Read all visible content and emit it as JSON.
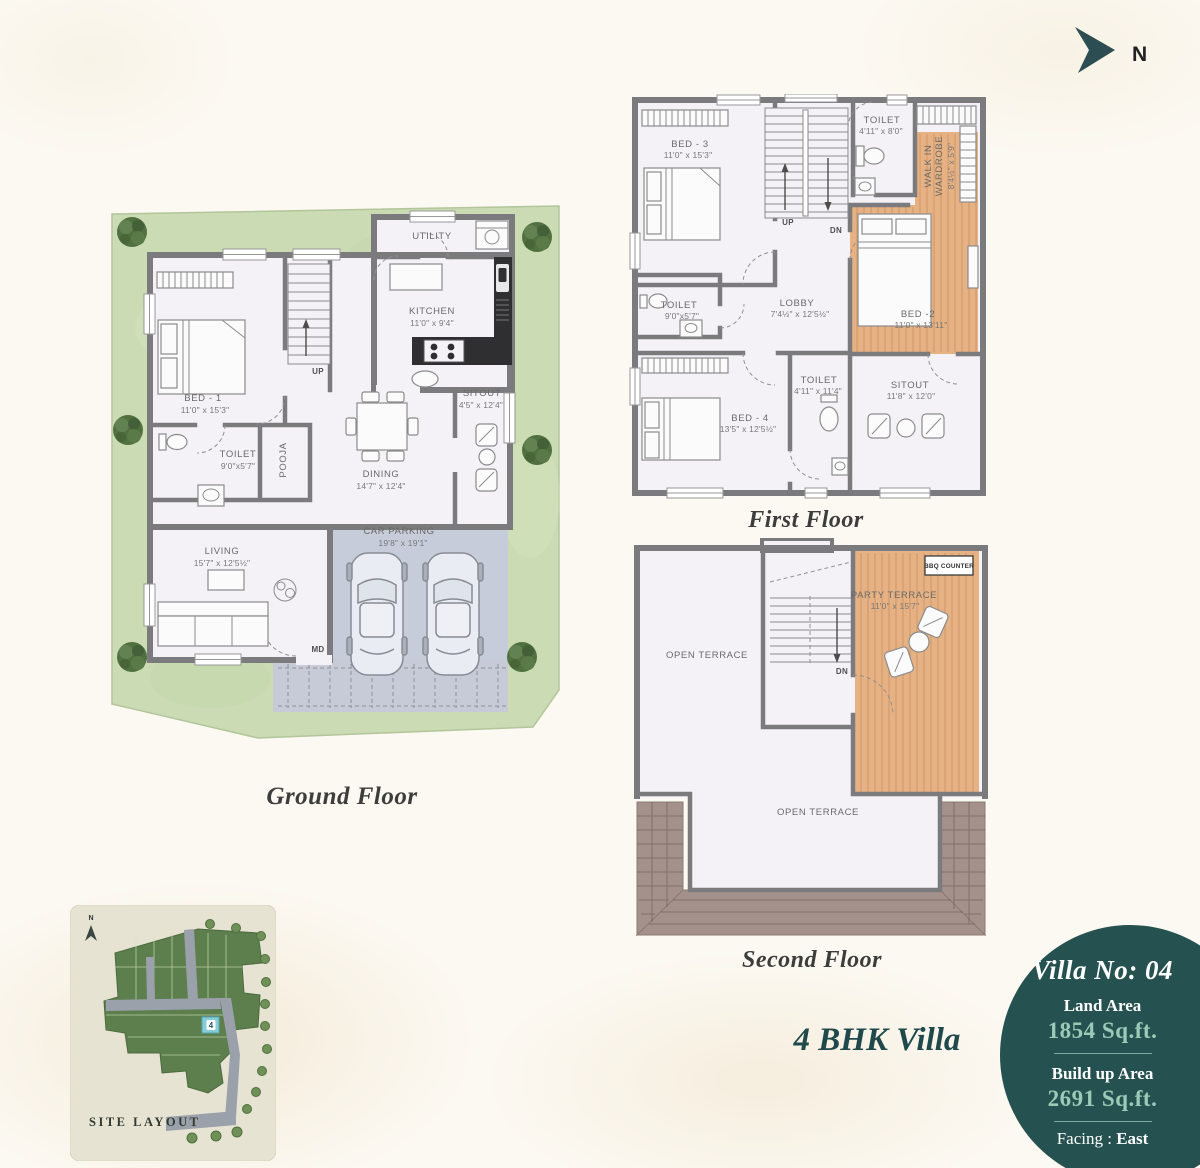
{
  "page": {
    "villa_type": "4 BHK Villa"
  },
  "north": {
    "label": "N"
  },
  "ground_floor": {
    "caption": "Ground Floor",
    "labels": {
      "utility": {
        "name": "UTILITY"
      },
      "kitchen": {
        "name": "KITCHEN",
        "dim": "11'0\" x 9'4\""
      },
      "bed1": {
        "name": "BED - 1",
        "dim": "11'0\" x 15'3\""
      },
      "toilet": {
        "name": "TOILET",
        "dim": "9'0\"x5'7\""
      },
      "pooja": {
        "name": "POOJA"
      },
      "dining": {
        "name": "DINING",
        "dim": "14'7\" x 12'4\""
      },
      "sitout": {
        "name": "SITOUT",
        "dim": "4'5\" x 12'4\""
      },
      "living": {
        "name": "LIVING",
        "dim": "15'7\" x 12'5½\""
      },
      "car_parking": {
        "name": "CAR PARKING",
        "dim": "19'8\" x 19'1\""
      },
      "up": "UP",
      "md": "MD"
    }
  },
  "first_floor": {
    "caption": "First Floor",
    "labels": {
      "bed3": {
        "name": "BED - 3",
        "dim": "11'0\" x 15'3\""
      },
      "toilet_top": {
        "name": "TOILET",
        "dim": "4'11\" x 8'0\""
      },
      "wardrobe": {
        "line1": "WALK IN",
        "line2": "WARDROBE",
        "dim": "8'4½\" x 5'9\""
      },
      "bed2": {
        "name": "BED -2",
        "dim": "11'0\" x 13'11\""
      },
      "lobby": {
        "name": "LOBBY",
        "dim": "7'4½\" x 12'5½\""
      },
      "toilet_left": {
        "name": "TOILET",
        "dim": "9'0\"x5'7\""
      },
      "bed4": {
        "name": "BED - 4",
        "dim": "13'5\" x 12'5½\""
      },
      "toilet_mid": {
        "name": "TOILET",
        "dim": "4'11\" x 11'4\""
      },
      "sitout": {
        "name": "SITOUT",
        "dim": "11'8\" x 12'0\""
      },
      "up": "UP",
      "dn": "DN"
    }
  },
  "second_floor": {
    "caption": "Second Floor",
    "labels": {
      "open_terrace_top": "OPEN TERRACE",
      "party_terrace": {
        "name": "PARTY TERRACE",
        "dim": "11'0\" x 15'7\""
      },
      "bbq": "BBQ COUNTER",
      "open_terrace_bottom": "OPEN TERRACE",
      "dn": "DN"
    }
  },
  "site_layout": {
    "caption": "SITE LAYOUT",
    "north_label": "N",
    "plot_number": "4"
  },
  "villa_info": {
    "title": "Villa No: 04",
    "land_area_label": "Land Area",
    "land_area_value": "1854 Sq.ft.",
    "build_area_label": "Build up Area",
    "build_area_value": "2691 Sq.ft.",
    "facing_label": "Facing : ",
    "facing_value": "East"
  },
  "colors": {
    "teal_circle": "#255150",
    "value_green": "#9bcab6",
    "grass": "#cbdcb4",
    "wood_floor": "#e6b284",
    "wall_gray": "#7b7b7d",
    "roof_tile": "#a5918b",
    "parking_slab": "#c6ccd9",
    "plot_highlight": "#87ccd9"
  }
}
